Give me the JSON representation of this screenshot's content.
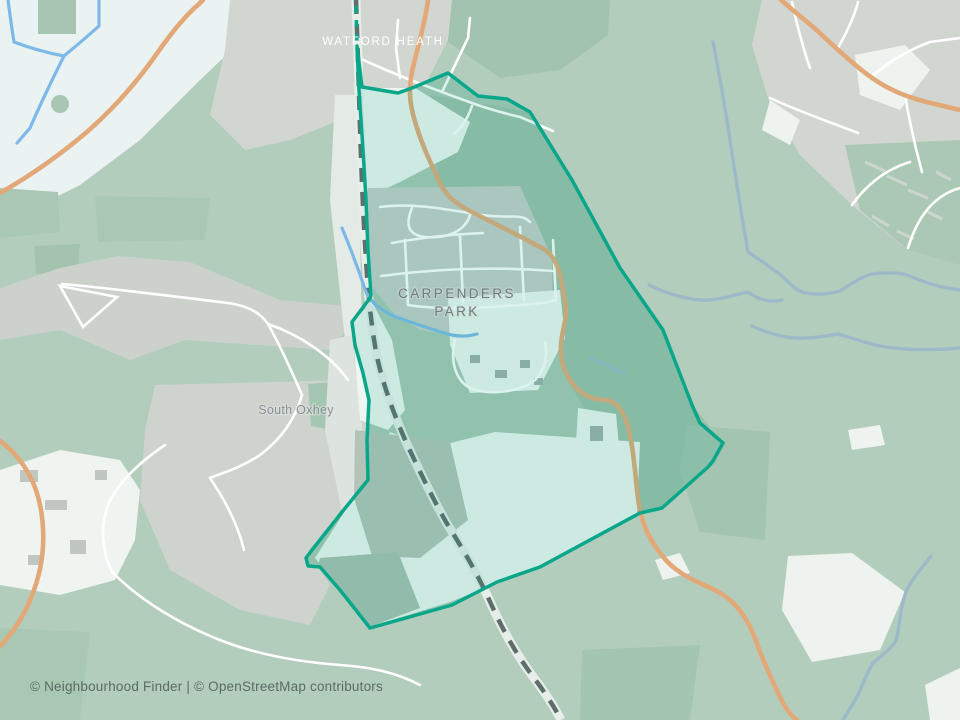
{
  "map": {
    "labels": {
      "watford_heath": "WATFORD HEATH",
      "carpenders_park_line1": "CARPENDERS",
      "carpenders_park_line2": "PARK",
      "south_oxhey": "South Oxhey"
    },
    "attribution": "© Neighbourhood Finder | © OpenStreetMap contributors",
    "boundary": {
      "area_name": "Carpenders Park",
      "stroke_color": "#0aa68a",
      "fill_rgba": "rgba(14,167,138,0.15)"
    },
    "colors": {
      "base_green": "#b3cdbd",
      "pale_field": "#eaf2f2",
      "urban_gray": "#d2d6d1",
      "wood_green": "#9cc0aa",
      "road_orange": "#e2a877",
      "street_white": "#ffffff",
      "stream_blue": "#7db9e8",
      "stream_muted": "#9db9c8",
      "railway_dash": "#5e6e6a",
      "railway_casing": "#e7ede8"
    }
  }
}
